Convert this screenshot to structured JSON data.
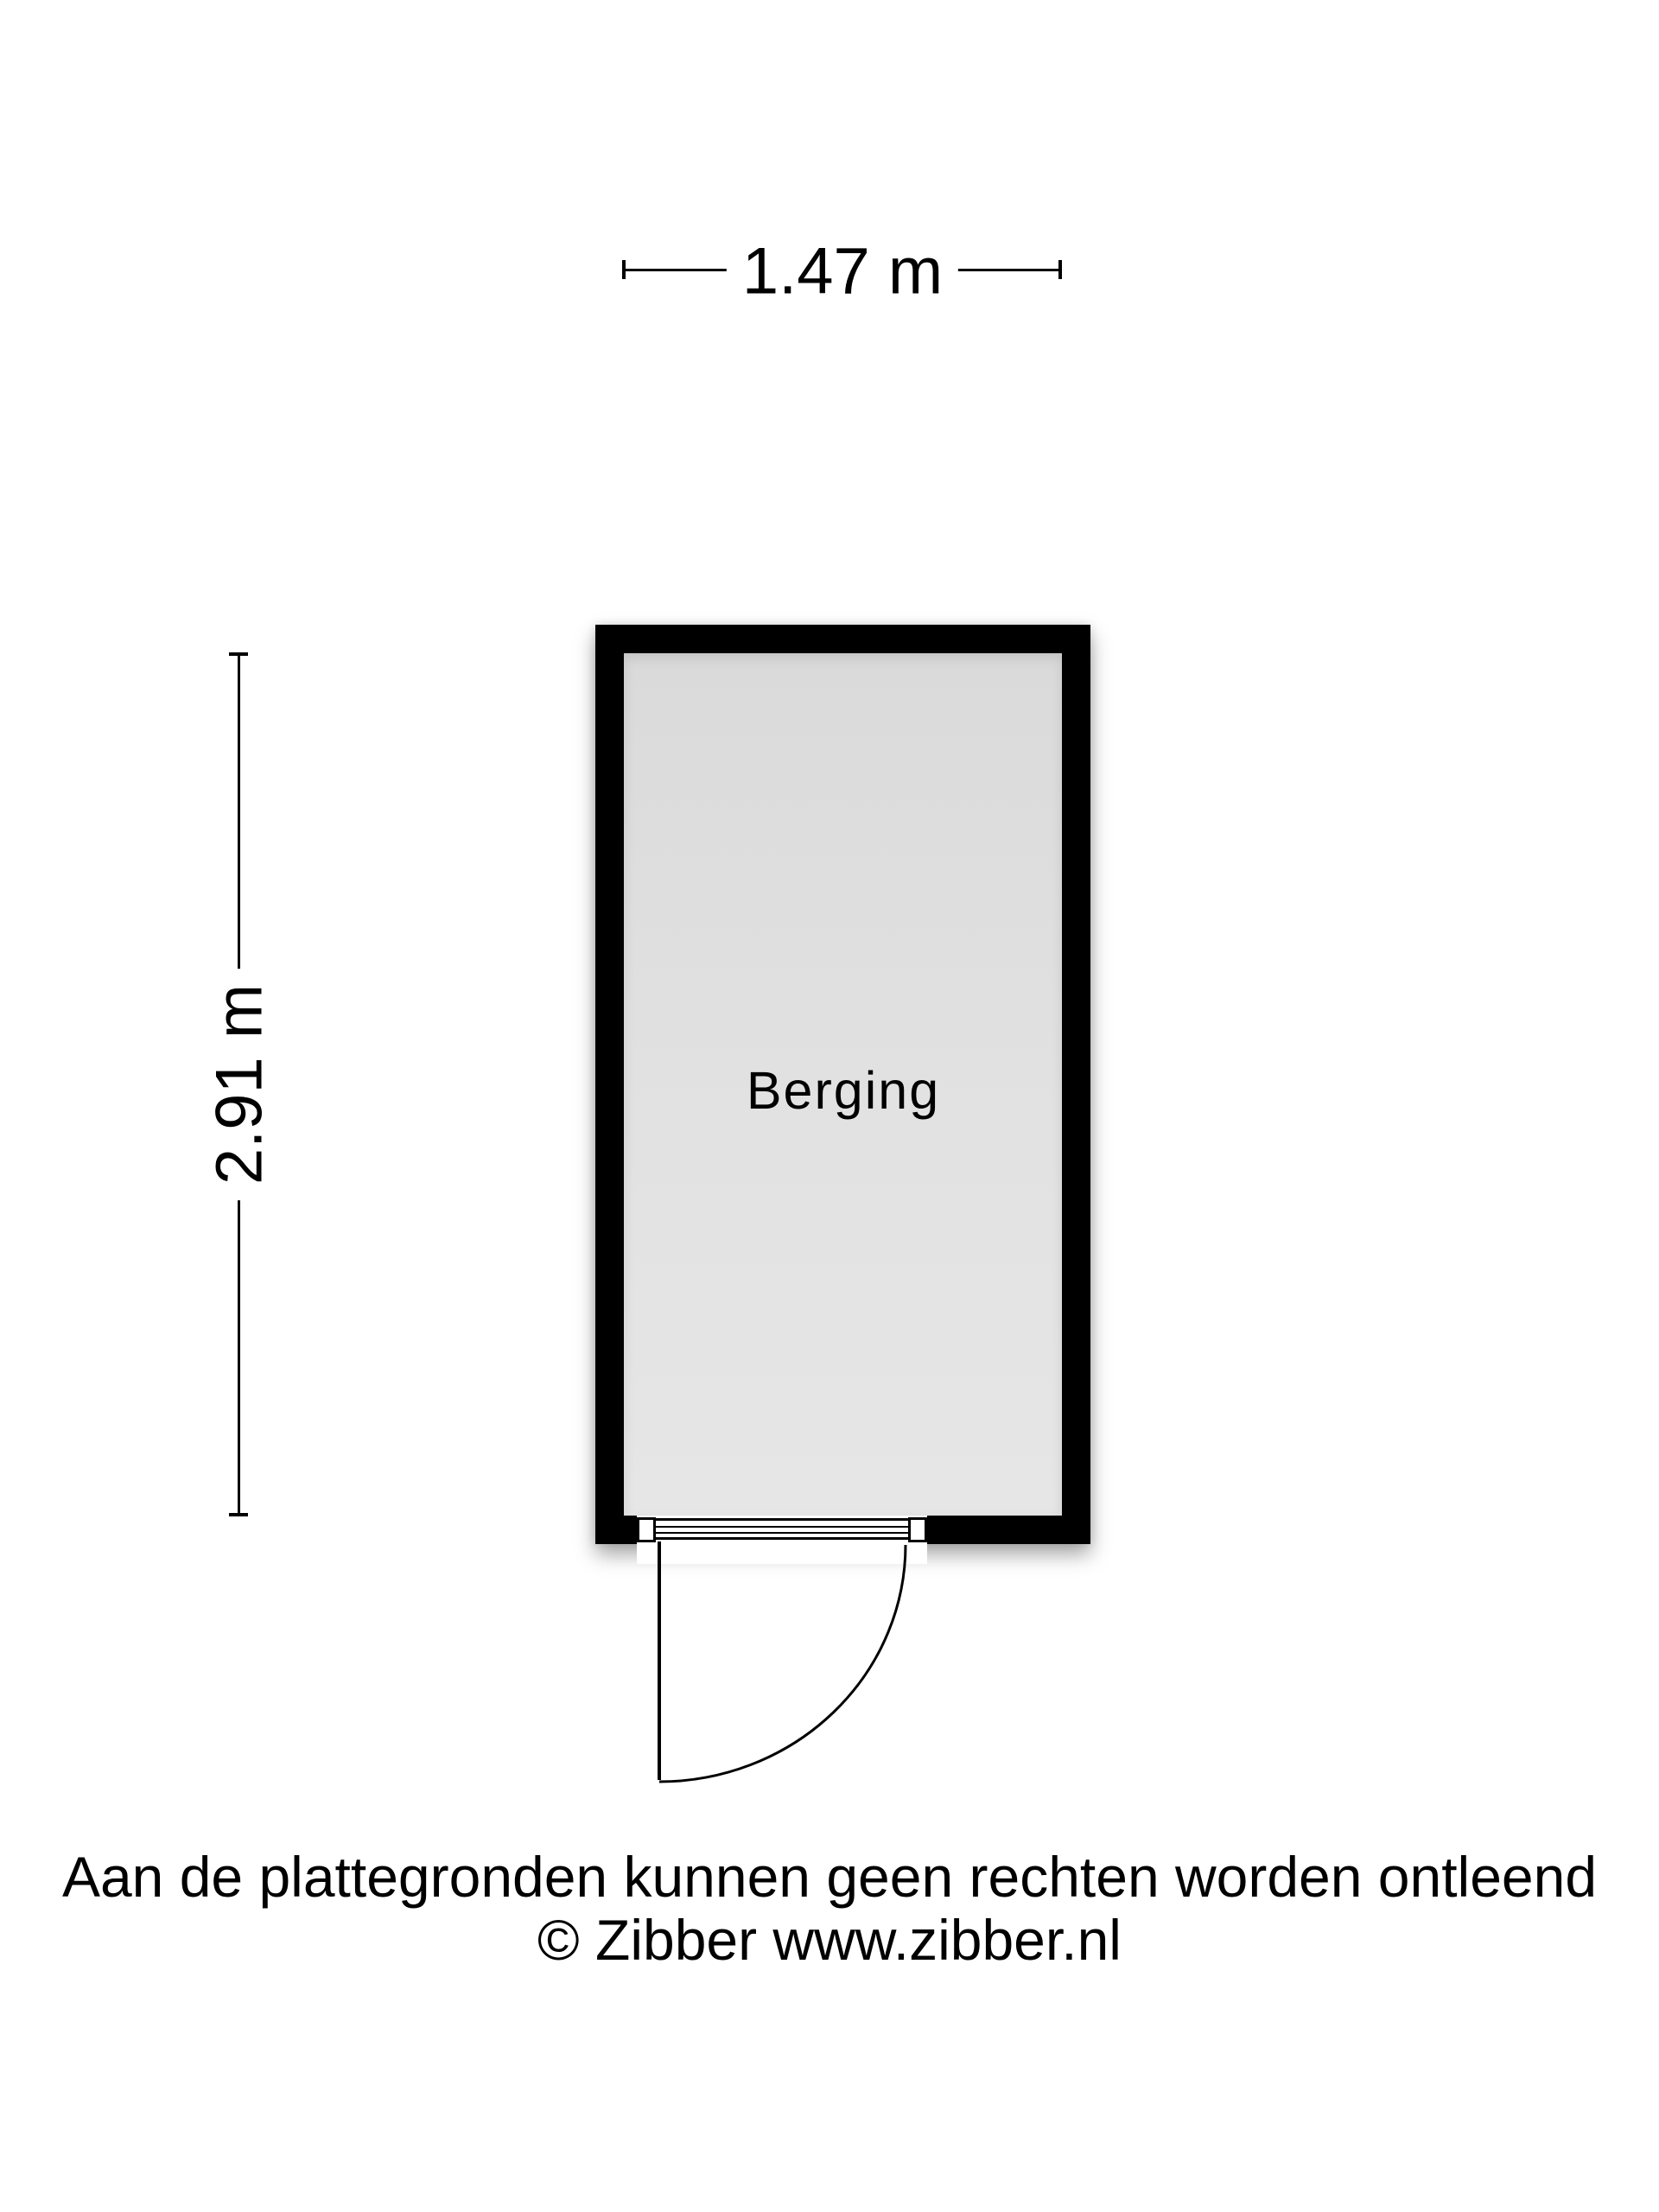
{
  "floorplan": {
    "room": {
      "label": "Berging"
    },
    "dimensions": {
      "width_label": "1.47 m",
      "height_label": "2.91 m"
    },
    "footer": {
      "disclaimer": "Aan de plattegronden kunnen geen rechten worden ontleend",
      "copyright": "© Zibber www.zibber.nl"
    },
    "colors": {
      "wall": "#000000",
      "floor": "#e0e0e0",
      "background": "#ffffff",
      "text": "#000000"
    }
  }
}
